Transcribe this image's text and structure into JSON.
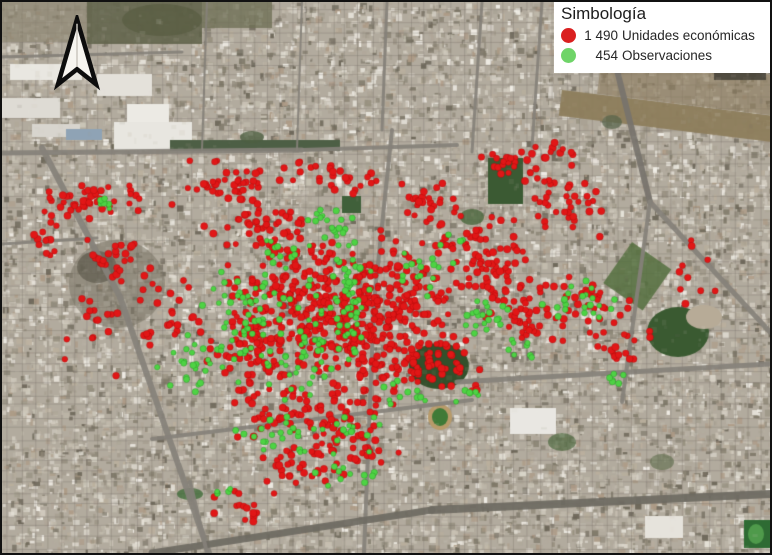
{
  "legend": {
    "title": "Simbología",
    "items": [
      {
        "count": "1 490",
        "label": "Unidades económicas",
        "color": "#da2020"
      },
      {
        "count": "454",
        "label": "Observaciones",
        "color": "#6fd468"
      }
    ]
  },
  "north_arrow": {
    "name": "north-arrow",
    "fill": "#f7f5f0",
    "outline": "#0d0d0d"
  },
  "map": {
    "width": 768,
    "height": 551,
    "seed": 20240611,
    "base_color": "#b2ab9e",
    "texture_count": 14000,
    "blend_count": 2200,
    "palette": [
      "#c7c0b2",
      "#b4ac9e",
      "#d4cec2",
      "#a59d8f",
      "#bfb8aa",
      "#97907f",
      "#ddd8cd",
      "#8b8474",
      "#cbc5b8",
      "#b0a698",
      "#e7e3da",
      "#7e7868",
      "#baaf9d",
      "#c2bcae",
      "#6b6557",
      "#f2efe8",
      "#ad9a85"
    ],
    "grid_color": "rgba(110,105,96,0.28)",
    "road_color": "#85817a",
    "features": [
      {
        "t": "rect",
        "x": 0,
        "y": 0,
        "w": 90,
        "h": 40,
        "c": "#8b8570",
        "a": 0.7
      },
      {
        "t": "rect",
        "x": 85,
        "y": 0,
        "w": 115,
        "h": 42,
        "c": "#63654c",
        "a": 0.9
      },
      {
        "t": "rect",
        "x": 200,
        "y": 0,
        "w": 70,
        "h": 26,
        "c": "#6f7156",
        "a": 0.8
      },
      {
        "t": "ell",
        "x": 160,
        "y": 18,
        "rx": 40,
        "ry": 16,
        "c": "#585c42",
        "a": 0.7
      },
      {
        "t": "rect",
        "x": 8,
        "y": 62,
        "w": 72,
        "h": 16,
        "c": "#e9e7e1"
      },
      {
        "t": "rect",
        "x": 0,
        "y": 96,
        "w": 58,
        "h": 20,
        "c": "#dedbd4"
      },
      {
        "t": "rect",
        "x": 95,
        "y": 72,
        "w": 55,
        "h": 22,
        "c": "#e4e1da"
      },
      {
        "t": "rect",
        "x": 125,
        "y": 102,
        "w": 42,
        "h": 26,
        "c": "#eceae4"
      },
      {
        "t": "rect",
        "x": 30,
        "y": 122,
        "w": 48,
        "h": 13,
        "c": "#d8d5ce"
      },
      {
        "t": "rect",
        "x": 112,
        "y": 120,
        "w": 78,
        "h": 28,
        "c": "#e8e6e0"
      },
      {
        "t": "rect",
        "x": 64,
        "y": 127,
        "w": 36,
        "h": 11,
        "c": "#8fa3b5"
      },
      {
        "t": "rect",
        "x": 560,
        "y": 88,
        "w": 230,
        "h": 26,
        "c": "#8d7d5c",
        "rot": 7,
        "a": 0.95
      },
      {
        "t": "rect",
        "x": 600,
        "y": 52,
        "w": 190,
        "h": 40,
        "c": "#8a795b",
        "rot": 7,
        "a": 0.6
      },
      {
        "t": "rect",
        "x": 712,
        "y": 58,
        "w": 52,
        "h": 20,
        "c": "#3e3c33",
        "a": 0.8
      },
      {
        "t": "ell",
        "x": 115,
        "y": 282,
        "rx": 48,
        "ry": 44,
        "c": "#7a7466",
        "a": 0.55
      },
      {
        "t": "ell",
        "x": 95,
        "y": 265,
        "rx": 20,
        "ry": 16,
        "c": "#565346",
        "a": 0.6
      },
      {
        "t": "rect",
        "x": 168,
        "y": 138,
        "w": 170,
        "h": 11,
        "c": "#4d5f45"
      },
      {
        "t": "rect",
        "x": 340,
        "y": 194,
        "w": 19,
        "h": 17,
        "c": "#40603a"
      },
      {
        "t": "rect",
        "x": 486,
        "y": 156,
        "w": 35,
        "h": 46,
        "c": "#3b5a33"
      },
      {
        "t": "ell",
        "x": 437,
        "y": 364,
        "rx": 30,
        "ry": 23,
        "c": "#33502b"
      },
      {
        "t": "ell",
        "x": 676,
        "y": 330,
        "rx": 31,
        "ry": 25,
        "c": "#3a5a31"
      },
      {
        "t": "ell",
        "x": 702,
        "y": 315,
        "rx": 18,
        "ry": 12,
        "c": "#b7ab97"
      },
      {
        "t": "rect",
        "x": 630,
        "y": 240,
        "w": 48,
        "h": 50,
        "c": "#55703f",
        "rot": 35,
        "a": 0.85
      },
      {
        "t": "ell",
        "x": 438,
        "y": 415,
        "rx": 12,
        "ry": 13,
        "c": "#b89b6a"
      },
      {
        "t": "ell",
        "x": 438,
        "y": 415,
        "rx": 8,
        "ry": 9,
        "c": "#3f7a37"
      },
      {
        "t": "rect",
        "x": 508,
        "y": 406,
        "w": 46,
        "h": 26,
        "c": "#e9e7e2"
      },
      {
        "t": "rect",
        "x": 643,
        "y": 514,
        "w": 38,
        "h": 22,
        "c": "#e6e3dc"
      },
      {
        "t": "rect",
        "x": 742,
        "y": 518,
        "w": 27,
        "h": 28,
        "c": "#2e6b33"
      },
      {
        "t": "ell",
        "x": 754,
        "y": 532,
        "rx": 8,
        "ry": 10,
        "c": "#4f9a4b"
      },
      {
        "t": "ell",
        "x": 470,
        "y": 215,
        "rx": 12,
        "ry": 8,
        "c": "#4a663c",
        "a": 0.8
      },
      {
        "t": "ell",
        "x": 560,
        "y": 440,
        "rx": 14,
        "ry": 9,
        "c": "#4e6a40",
        "a": 0.7
      },
      {
        "t": "ell",
        "x": 610,
        "y": 120,
        "rx": 10,
        "ry": 7,
        "c": "#55644a",
        "a": 0.7
      },
      {
        "t": "ell",
        "x": 250,
        "y": 135,
        "rx": 12,
        "ry": 6,
        "c": "#4d5f41",
        "a": 0.8
      },
      {
        "t": "ell",
        "x": 660,
        "y": 460,
        "rx": 12,
        "ry": 8,
        "c": "#5b6b4a",
        "a": 0.6
      },
      {
        "t": "ell",
        "x": 188,
        "y": 492,
        "rx": 13,
        "ry": 6,
        "c": "#3f6b38",
        "a": 0.8
      }
    ],
    "roads": [
      [
        40,
        146,
        118,
        295,
        6
      ],
      [
        118,
        295,
        207,
        551,
        6
      ],
      [
        0,
        151,
        300,
        148,
        5
      ],
      [
        300,
        148,
        455,
        143,
        4
      ],
      [
        390,
        128,
        372,
        300,
        4
      ],
      [
        372,
        300,
        362,
        551,
        4
      ],
      [
        0,
        55,
        180,
        50,
        3
      ],
      [
        205,
        0,
        200,
        148,
        2
      ],
      [
        300,
        0,
        295,
        148,
        2
      ],
      [
        385,
        0,
        380,
        128,
        3
      ],
      [
        480,
        0,
        470,
        150,
        3
      ],
      [
        540,
        0,
        530,
        145,
        3
      ],
      [
        598,
        0,
        648,
        200,
        6,
        "#77736c"
      ],
      [
        648,
        200,
        620,
        400,
        4
      ],
      [
        648,
        200,
        768,
        330,
        5
      ],
      [
        700,
        0,
        768,
        70,
        4
      ],
      [
        455,
        380,
        768,
        362,
        5
      ],
      [
        150,
        437,
        470,
        398,
        4
      ],
      [
        150,
        551,
        430,
        508,
        7,
        "#6e6a62"
      ],
      [
        430,
        508,
        768,
        492,
        8,
        "#6e6a62"
      ],
      [
        188,
        480,
        205,
        551,
        4
      ],
      [
        0,
        242,
        95,
        236,
        3
      ]
    ],
    "layers": [
      {
        "name": "unidades-economicas",
        "color": "#e11717",
        "edge": "rgba(120,0,0,0.35)",
        "radius": 3.3,
        "clusters": [
          [
            90,
            200,
            62,
            22,
            46
          ],
          [
            45,
            238,
            16,
            28,
            13
          ],
          [
            118,
            258,
            42,
            28,
            24
          ],
          [
            95,
            330,
            40,
            55,
            16
          ],
          [
            168,
            305,
            38,
            55,
            28
          ],
          [
            228,
            182,
            68,
            26,
            42
          ],
          [
            330,
            172,
            58,
            22,
            28
          ],
          [
            262,
            228,
            66,
            34,
            50
          ],
          [
            300,
            292,
            85,
            58,
            215
          ],
          [
            362,
            342,
            78,
            52,
            160
          ],
          [
            252,
            352,
            58,
            48,
            85
          ],
          [
            312,
            412,
            88,
            34,
            85
          ],
          [
            402,
            282,
            58,
            58,
            105
          ],
          [
            432,
            362,
            48,
            34,
            55
          ],
          [
            302,
            462,
            78,
            24,
            38
          ],
          [
            240,
            502,
            38,
            20,
            15
          ],
          [
            362,
            447,
            48,
            22,
            22
          ],
          [
            482,
            252,
            52,
            44,
            75
          ],
          [
            522,
            312,
            48,
            38,
            52
          ],
          [
            562,
            202,
            42,
            42,
            38
          ],
          [
            588,
            302,
            42,
            34,
            32
          ],
          [
            622,
            342,
            32,
            24,
            16
          ],
          [
            548,
            152,
            42,
            14,
            15
          ],
          [
            682,
            272,
            38,
            44,
            10
          ],
          [
            432,
            202,
            38,
            28,
            28
          ],
          [
            502,
            162,
            38,
            17,
            18
          ]
        ]
      },
      {
        "name": "observaciones",
        "color": "#4ed344",
        "edge": "rgba(20,110,20,0.45)",
        "radius": 2.9,
        "clusters": [
          [
            350,
            292,
            24,
            72,
            50
          ],
          [
            300,
            342,
            78,
            66,
            62
          ],
          [
            240,
            312,
            52,
            52,
            40
          ],
          [
            192,
            362,
            42,
            42,
            25
          ],
          [
            107,
            203,
            13,
            9,
            6
          ],
          [
            330,
            217,
            28,
            24,
            16
          ],
          [
            432,
            262,
            42,
            42,
            20
          ],
          [
            482,
            317,
            28,
            24,
            20
          ],
          [
            557,
            297,
            42,
            24,
            16
          ],
          [
            610,
            377,
            12,
            10,
            6
          ],
          [
            332,
            432,
            66,
            24,
            24
          ],
          [
            352,
            477,
            42,
            17,
            11
          ],
          [
            262,
            432,
            38,
            24,
            13
          ],
          [
            407,
            392,
            28,
            18,
            11
          ],
          [
            470,
            390,
            18,
            11,
            6
          ],
          [
            282,
            252,
            38,
            28,
            15
          ],
          [
            522,
            347,
            24,
            14,
            8
          ],
          [
            600,
            302,
            18,
            14,
            6
          ],
          [
            215,
            490,
            18,
            8,
            5
          ]
        ]
      }
    ]
  }
}
